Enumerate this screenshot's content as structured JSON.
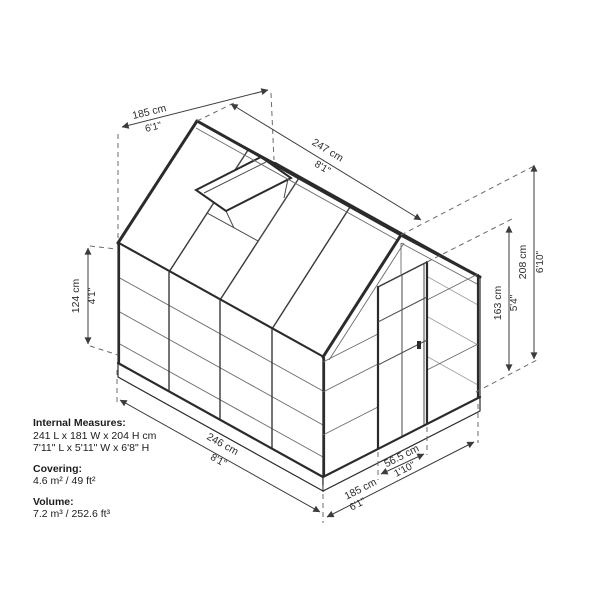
{
  "diagram": {
    "title": "greenhouse-dimension-diagram",
    "line_color": "#2b2b2b",
    "dim_color": "#3c3c3c",
    "dimensions": {
      "roof_width": {
        "cm": "185 cm",
        "ft": "6'1\""
      },
      "roof_length": {
        "cm": "247 cm",
        "ft": "8'1\""
      },
      "side_wall_height": {
        "cm": "124 cm",
        "ft": "4'1\""
      },
      "total_height": {
        "cm": "208 cm",
        "ft": "6'10\""
      },
      "door_height": {
        "cm": "163 cm",
        "ft": "5'4\""
      },
      "base_length": {
        "cm": "246 cm",
        "ft": "8'1\""
      },
      "door_width": {
        "cm": "56.5 cm",
        "ft": "1'10\""
      },
      "base_width": {
        "cm": "185 cm",
        "ft": "6'1\""
      }
    },
    "specs": {
      "internal_measures_label": "Internal Measures:",
      "internal_measures_cm": "241 L x 181 W x 204 H cm",
      "internal_measures_ft": "7'11\" L x 5'11\" W x 6'8\" H",
      "covering_label": "Covering:",
      "covering_value": "4.6 m² / 49 ft²",
      "volume_label": "Volume:",
      "volume_value": "7.2 m³ / 252.6 ft³"
    }
  }
}
